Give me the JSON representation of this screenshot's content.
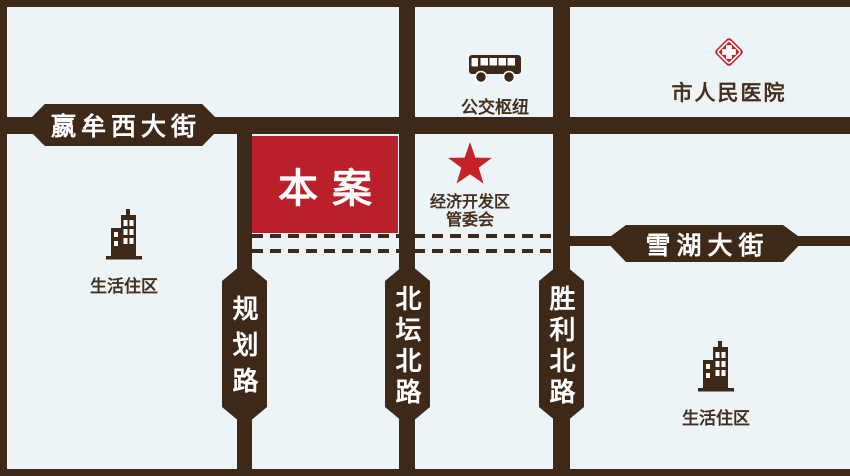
{
  "colors": {
    "background": "#edf4f8",
    "road": "#3e2817",
    "ink": "#45301f",
    "site-red": "#b9202a",
    "icon-red": "#c62329",
    "banner-text": "#ffffff"
  },
  "site": {
    "label": "本案"
  },
  "streets": {
    "yingmou": {
      "label": "嬴牟西大街"
    },
    "xuehu": {
      "label": "雪湖大街"
    },
    "guihua": {
      "label": "规划路"
    },
    "beitan": {
      "label": "北坛北路"
    },
    "shengli": {
      "label": "胜利北路"
    }
  },
  "pois": [
    {
      "id": "bus-hub",
      "icon": "bus-icon",
      "label": "公交枢纽"
    },
    {
      "id": "hospital",
      "icon": "hospital-cross-icon",
      "label": "市人民医院"
    },
    {
      "id": "edz-committee",
      "icon": "star-icon",
      "label_line1": "经济开发区",
      "label_line2": "管委会"
    },
    {
      "id": "residential-west",
      "icon": "building-icon",
      "label": "生活住区"
    },
    {
      "id": "residential-southeast",
      "icon": "building-icon",
      "label": "生活住区"
    }
  ]
}
